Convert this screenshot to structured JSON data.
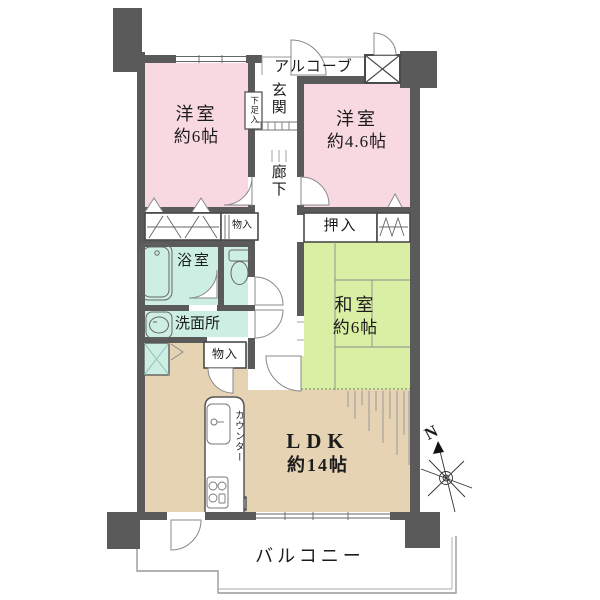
{
  "rooms": {
    "western6": {
      "name": "洋室",
      "size": "約6帖"
    },
    "western46": {
      "name": "洋室",
      "size": "約4.6帖"
    },
    "japanese": {
      "name": "和室",
      "size": "約6帖"
    },
    "ldk": {
      "name": "LDK",
      "size": "約14帖"
    }
  },
  "labels": {
    "alcove": "アルコーブ",
    "entrance": "玄関",
    "shoe_box": "下足入",
    "corridor": "廊下",
    "oshiire": "押入",
    "storage_small": "物入",
    "bathroom": "浴室",
    "washroom": "洗面所",
    "storage_ldk": "物入",
    "counter": "カウンター",
    "balcony": "バルコニー",
    "compass_north": "N"
  },
  "colors": {
    "wall": "#5a5a5a",
    "western_room": "#f8d8e1",
    "japanese_room": "#d9efa3",
    "wet_area": "#cdeee3",
    "ldk": "#e5d3b4",
    "outline": "#999999",
    "text": "#1c1c1c"
  }
}
